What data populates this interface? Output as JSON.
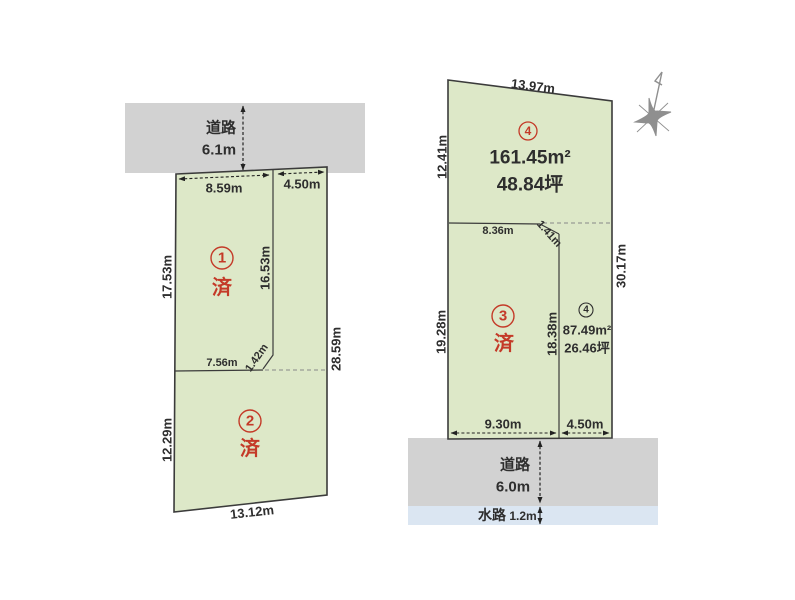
{
  "colors": {
    "plot_fill": "#dde8c8",
    "plot_border": "#3b3b3b",
    "road_fill": "#d2d2d2",
    "water_fill": "#dbe6f2",
    "accent_red": "#c43a28",
    "text": "#2e2e2e",
    "compass_gray": "#8f8f8f"
  },
  "left": {
    "road": {
      "label": "道路",
      "width": "6.1m"
    },
    "lots": [
      {
        "num": "1",
        "status": "済"
      },
      {
        "num": "2",
        "status": "済"
      }
    ],
    "dims": {
      "top_left": "8.59m",
      "top_right": "4.50m",
      "left_upper": "17.53m",
      "inner_vertical": "16.53m",
      "right_side": "28.59m",
      "mid_horizontal": "7.56m",
      "mid_diagonal": "1.42m",
      "left_lower": "12.29m",
      "bottom": "13.12m"
    }
  },
  "right": {
    "dims": {
      "top": "13.97m",
      "left_upper": "12.41m",
      "mid_horizontal": "8.36m",
      "mid_diagonal": "1.41m",
      "right_side": "30.17m",
      "left_lower": "19.28m",
      "inner_vertical": "18.38m",
      "bottom_left": "9.30m",
      "bottom_right": "4.50m"
    },
    "lot4_upper": {
      "num": "4",
      "area_m2": "161.45m²",
      "area_tsubo": "48.84坪"
    },
    "lot3": {
      "num": "3",
      "status": "済"
    },
    "lot4_lower": {
      "num": "4",
      "area_m2": "87.49m²",
      "area_tsubo": "26.46坪"
    },
    "road": {
      "label": "道路",
      "width": "6.0m"
    },
    "water": {
      "label": "水路",
      "width": "1.2m"
    }
  }
}
